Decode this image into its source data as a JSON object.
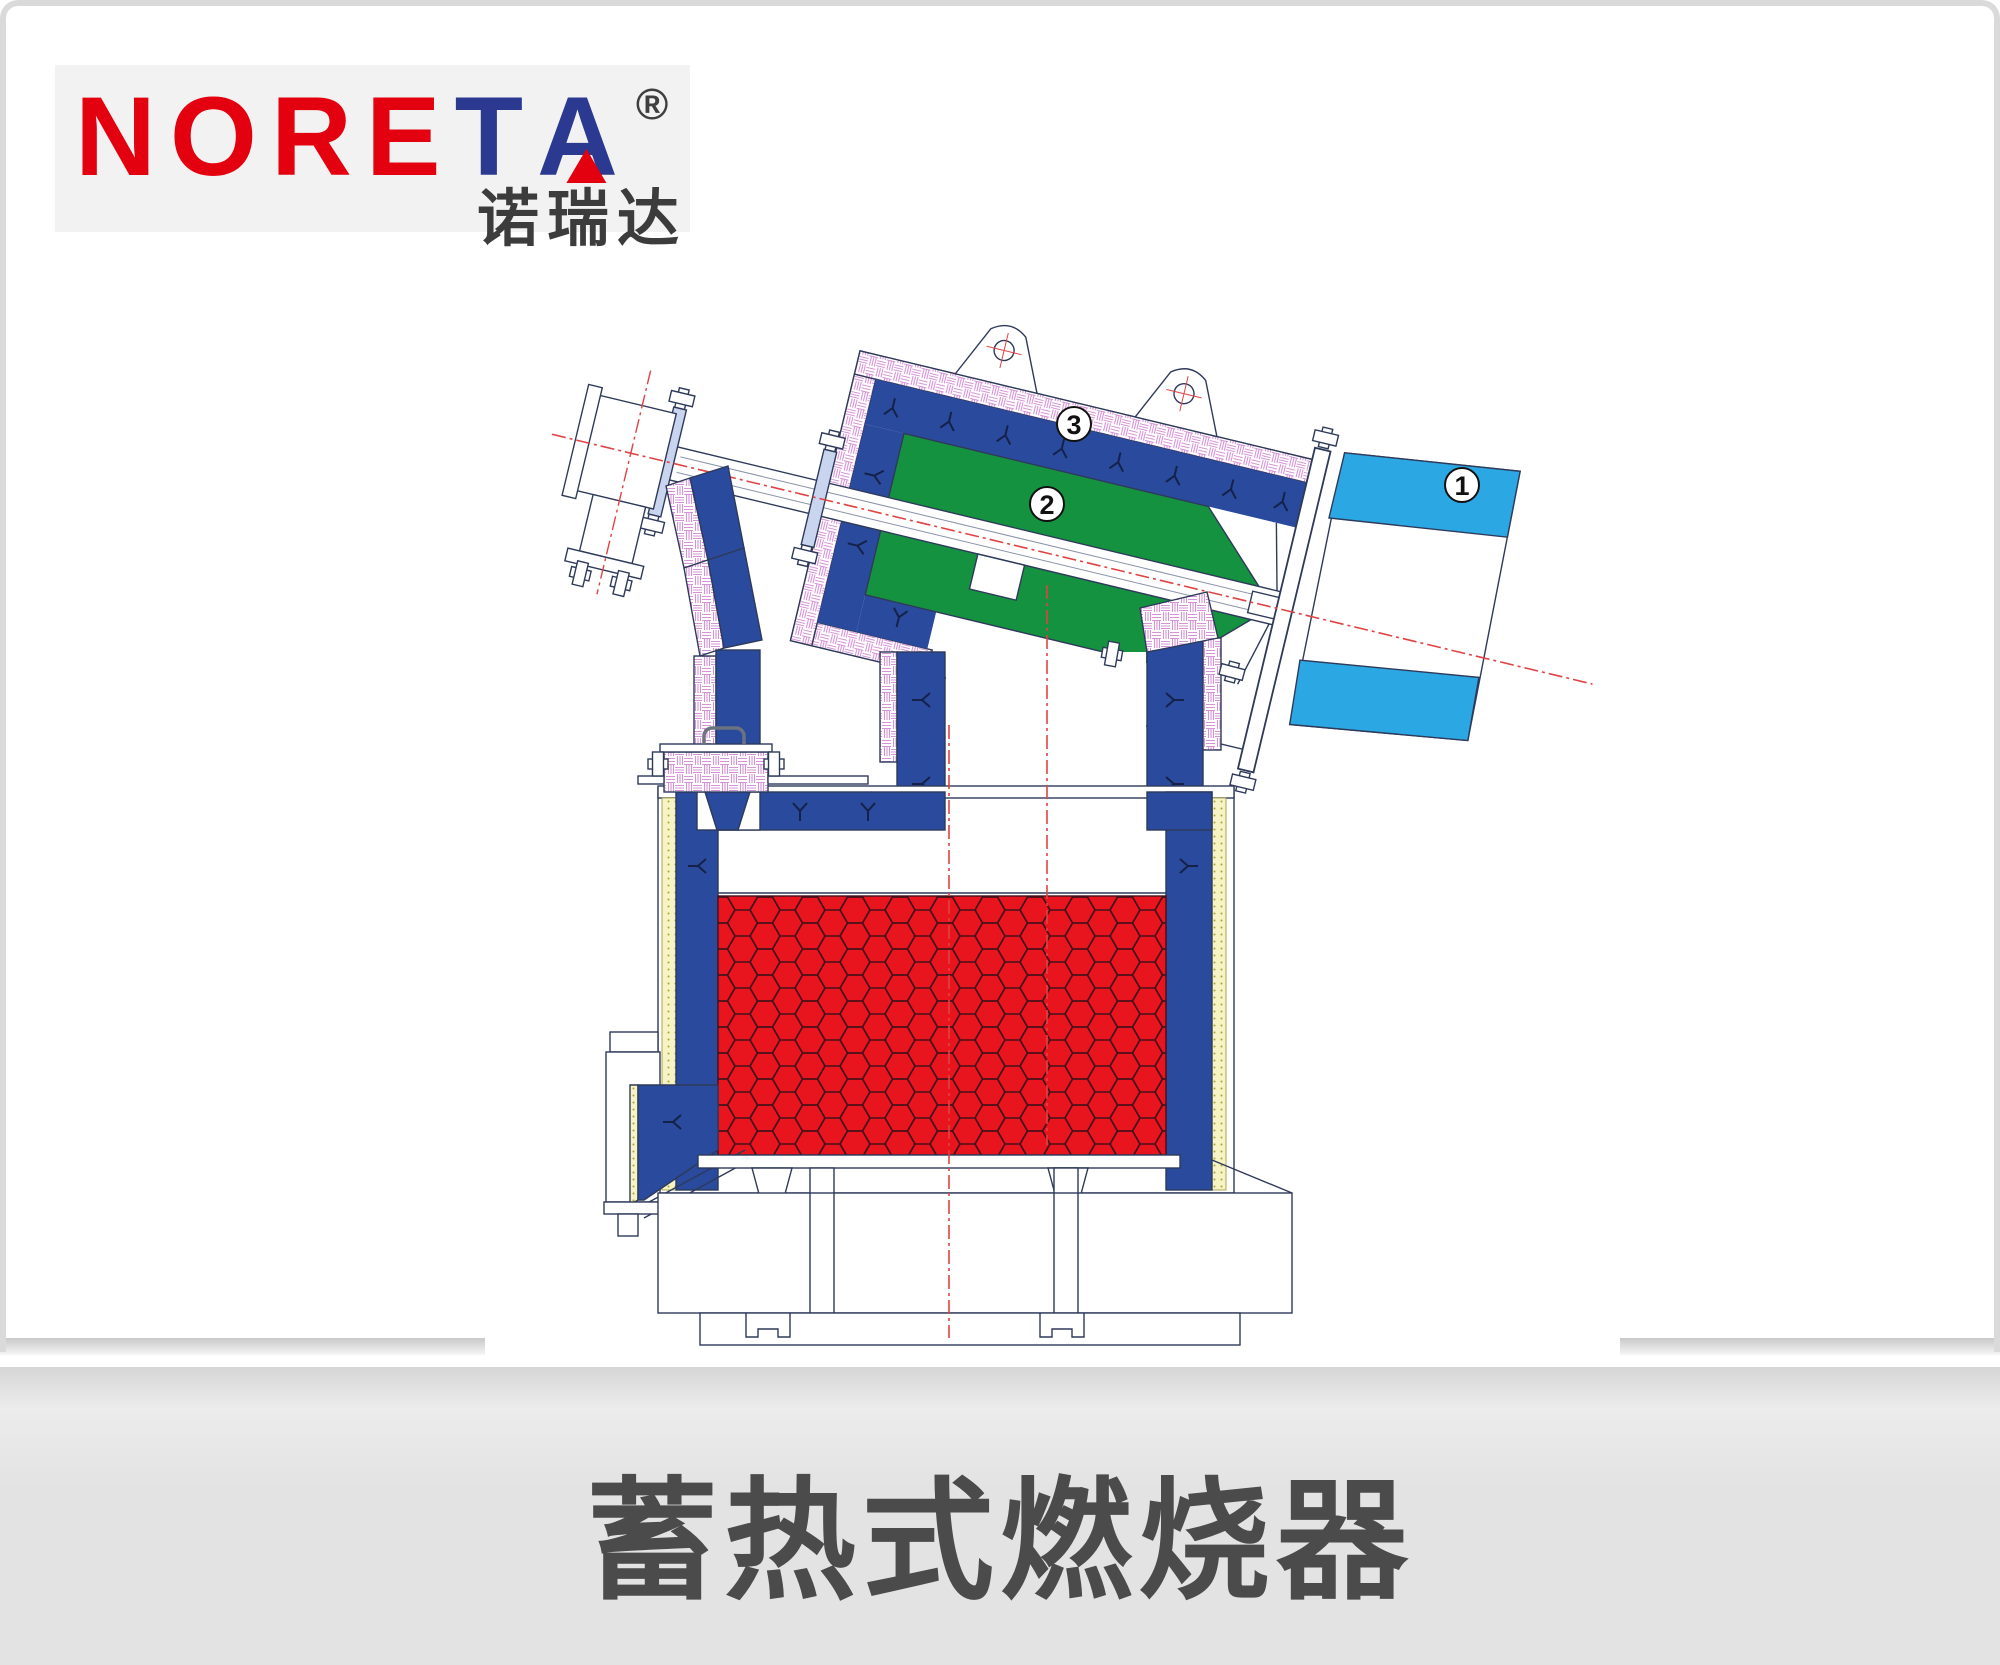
{
  "page": {
    "background": "#ffffff",
    "frame_border_color": "#dadada"
  },
  "logo": {
    "text_red": "NORE",
    "text_blue_t": "T",
    "text_blue_a": "A",
    "reg_mark": "®",
    "chinese": "诺瑞达",
    "brand_red": "#e3000f",
    "brand_navy": "#2b3990",
    "box_bg": "#f3f2f2"
  },
  "product_image": {
    "description": "Technical cross-section CAD drawing of a regenerative burner tilted at an angle, mounted on a furnace regenerator box",
    "bg": "#ffffff",
    "callouts": [
      {
        "num": "1"
      },
      {
        "num": "2"
      },
      {
        "num": "3"
      }
    ],
    "colors": {
      "lining_blue": "#2a4a9d",
      "duct_green": "#15923f",
      "air_cone_cyan": "#2ba7e3",
      "honeycomb_red": "#e8141e",
      "insulation_pink_hatch": "#d793d7",
      "insulation_yellow": "#f6f3c4",
      "centerline_red": "#e04343",
      "outline_navy": "#2e3a5a"
    }
  },
  "footer": {
    "title": "蓄热式燃烧器",
    "bg": "#e3e3e3",
    "title_color": "#4b4b4b",
    "next_button": {
      "icon": "chevron-right",
      "ring_color": "#4d4d4d"
    }
  }
}
